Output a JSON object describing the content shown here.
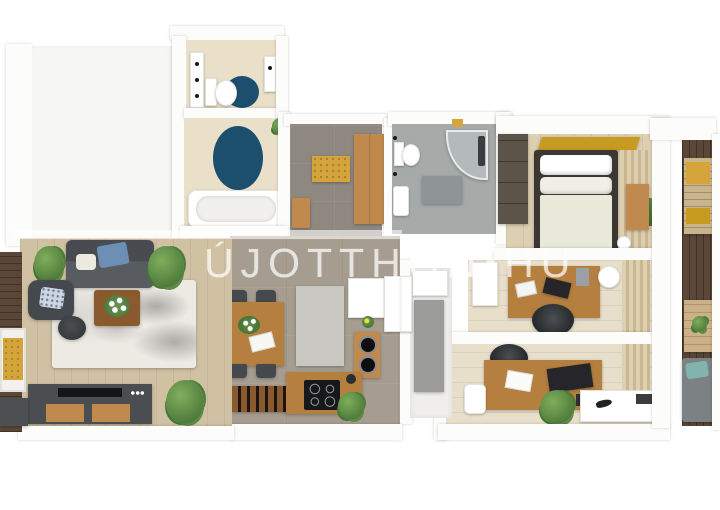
{
  "watermark": {
    "left": "ÚJOTTHON",
    "right": "HU",
    "dots": 3
  },
  "colors": {
    "bg": "#ffffff",
    "wall": "#fcfcfb",
    "emptyRoom": "#f7f7f5",
    "bathFloor": "#eadfc8",
    "navyRug": "#1c4e6d",
    "hallFloor": "#8e8880",
    "diningFloor": "#a69d90",
    "bathGrayFloor": "#a6aaa9",
    "grayMat": "#8f9496",
    "showerGlass": "#b4babc",
    "bedroomFloor": "#ddcfb2",
    "paleWoodFloor": "#e8dfcb",
    "livingFloor": "#d0c1a3",
    "deck": "#5a4737",
    "oak": "#c08a4e",
    "woodTable": "#b5803f",
    "woodDark": "#8a5a2e",
    "wardrobeDark": "#5c5349",
    "bedFrame": "#3b3733",
    "duvet": "#e9e9da",
    "sofa": "#585c61",
    "chairDark": "#45494d",
    "charcoal": "#26262a",
    "yellow": "#d5a53c",
    "gold": "#c79a20",
    "teal": "#83b3ae",
    "blanketBlue": "#6e8fb4",
    "plant": "#4f7d3c",
    "marbleRug": "#eceae3",
    "runnerGray": "#c9c7c2",
    "applianceBlack": "#17181a",
    "white": "#ffffff",
    "curtain": "#d8c9a8",
    "watermark": "rgba(255,255,255,0.66)"
  }
}
